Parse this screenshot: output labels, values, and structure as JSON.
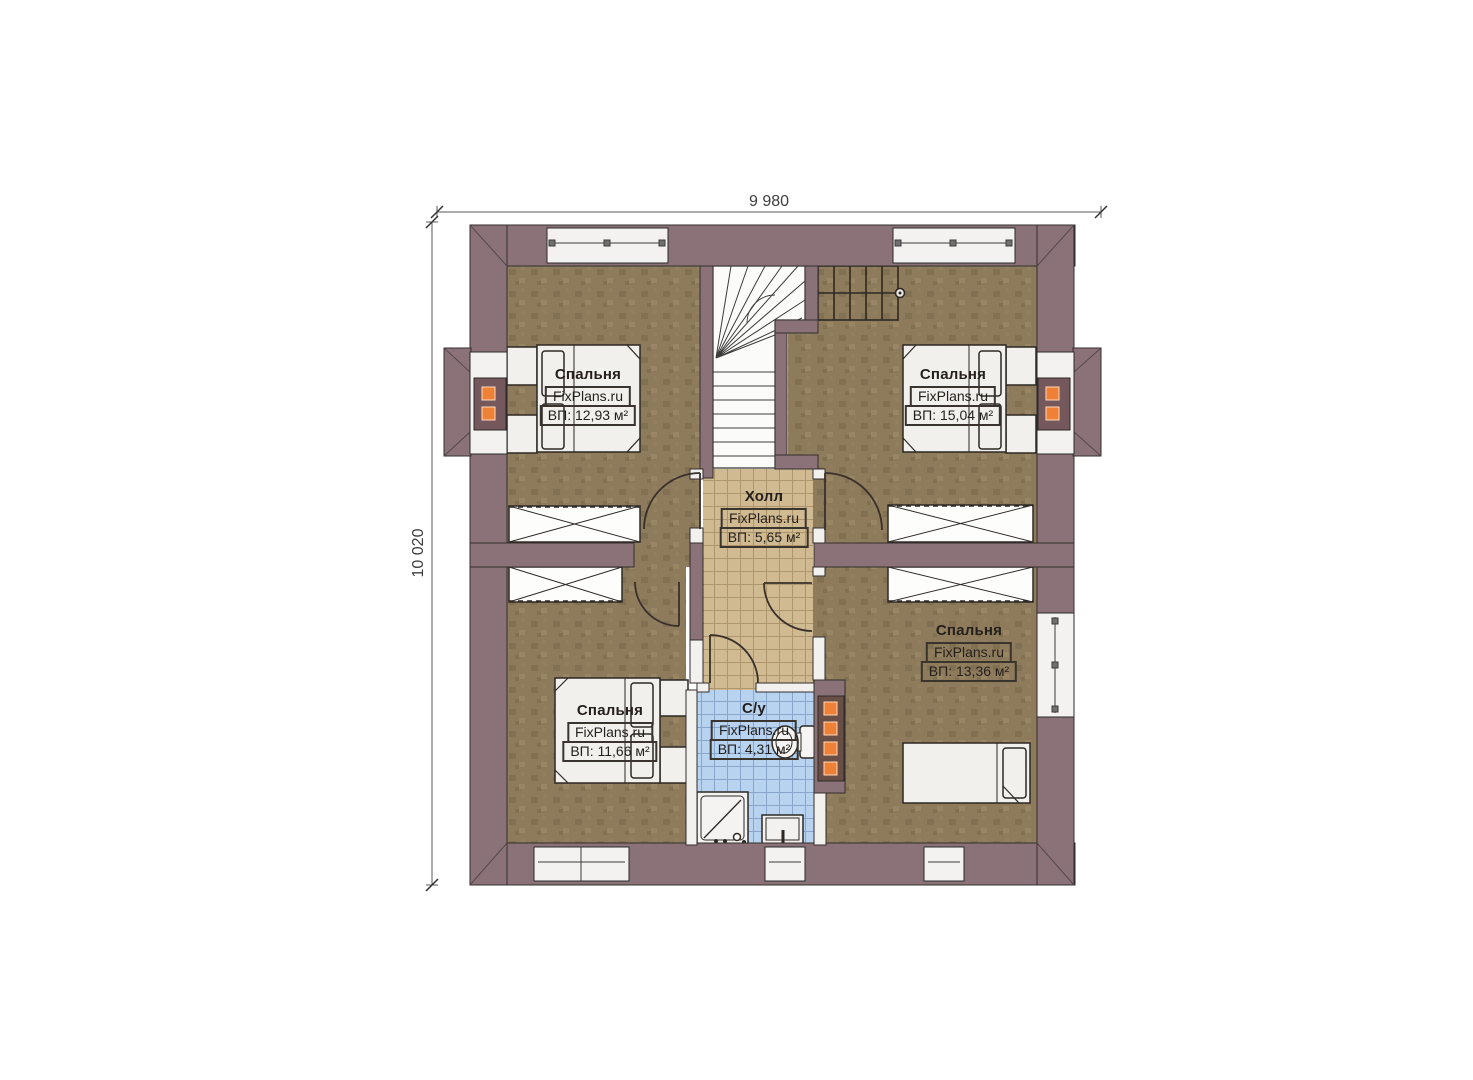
{
  "dimensions": {
    "width": "9 980",
    "height": "10 020"
  },
  "watermark": {
    "text": "FixPlans.ru"
  },
  "rooms": [
    {
      "key": "bedroom-top-left",
      "name": "Спальня",
      "area": "ВП: 12,93 м²"
    },
    {
      "key": "bedroom-top-right",
      "name": "Спальня",
      "area": "ВП: 15,04 м²"
    },
    {
      "key": "hall",
      "name": "Холл",
      "area": "ВП: 5,65 м²"
    },
    {
      "key": "bedroom-right",
      "name": "Спальня",
      "area": "ВП: 13,36 м²"
    },
    {
      "key": "bedroom-bottom-left",
      "name": "Спальня",
      "area": "ВП: 11,66 м²"
    },
    {
      "key": "bathroom",
      "name": "С/у",
      "area": "ВП: 4,31 м²"
    }
  ],
  "colors": {
    "wall": "#8b7278",
    "floor": "#8d7b5c",
    "hall_tile": "#d0ba92",
    "bath_tile": "#b7d3f0",
    "radiator_accent": "#ef8136",
    "furniture": "#f1f0ed"
  }
}
